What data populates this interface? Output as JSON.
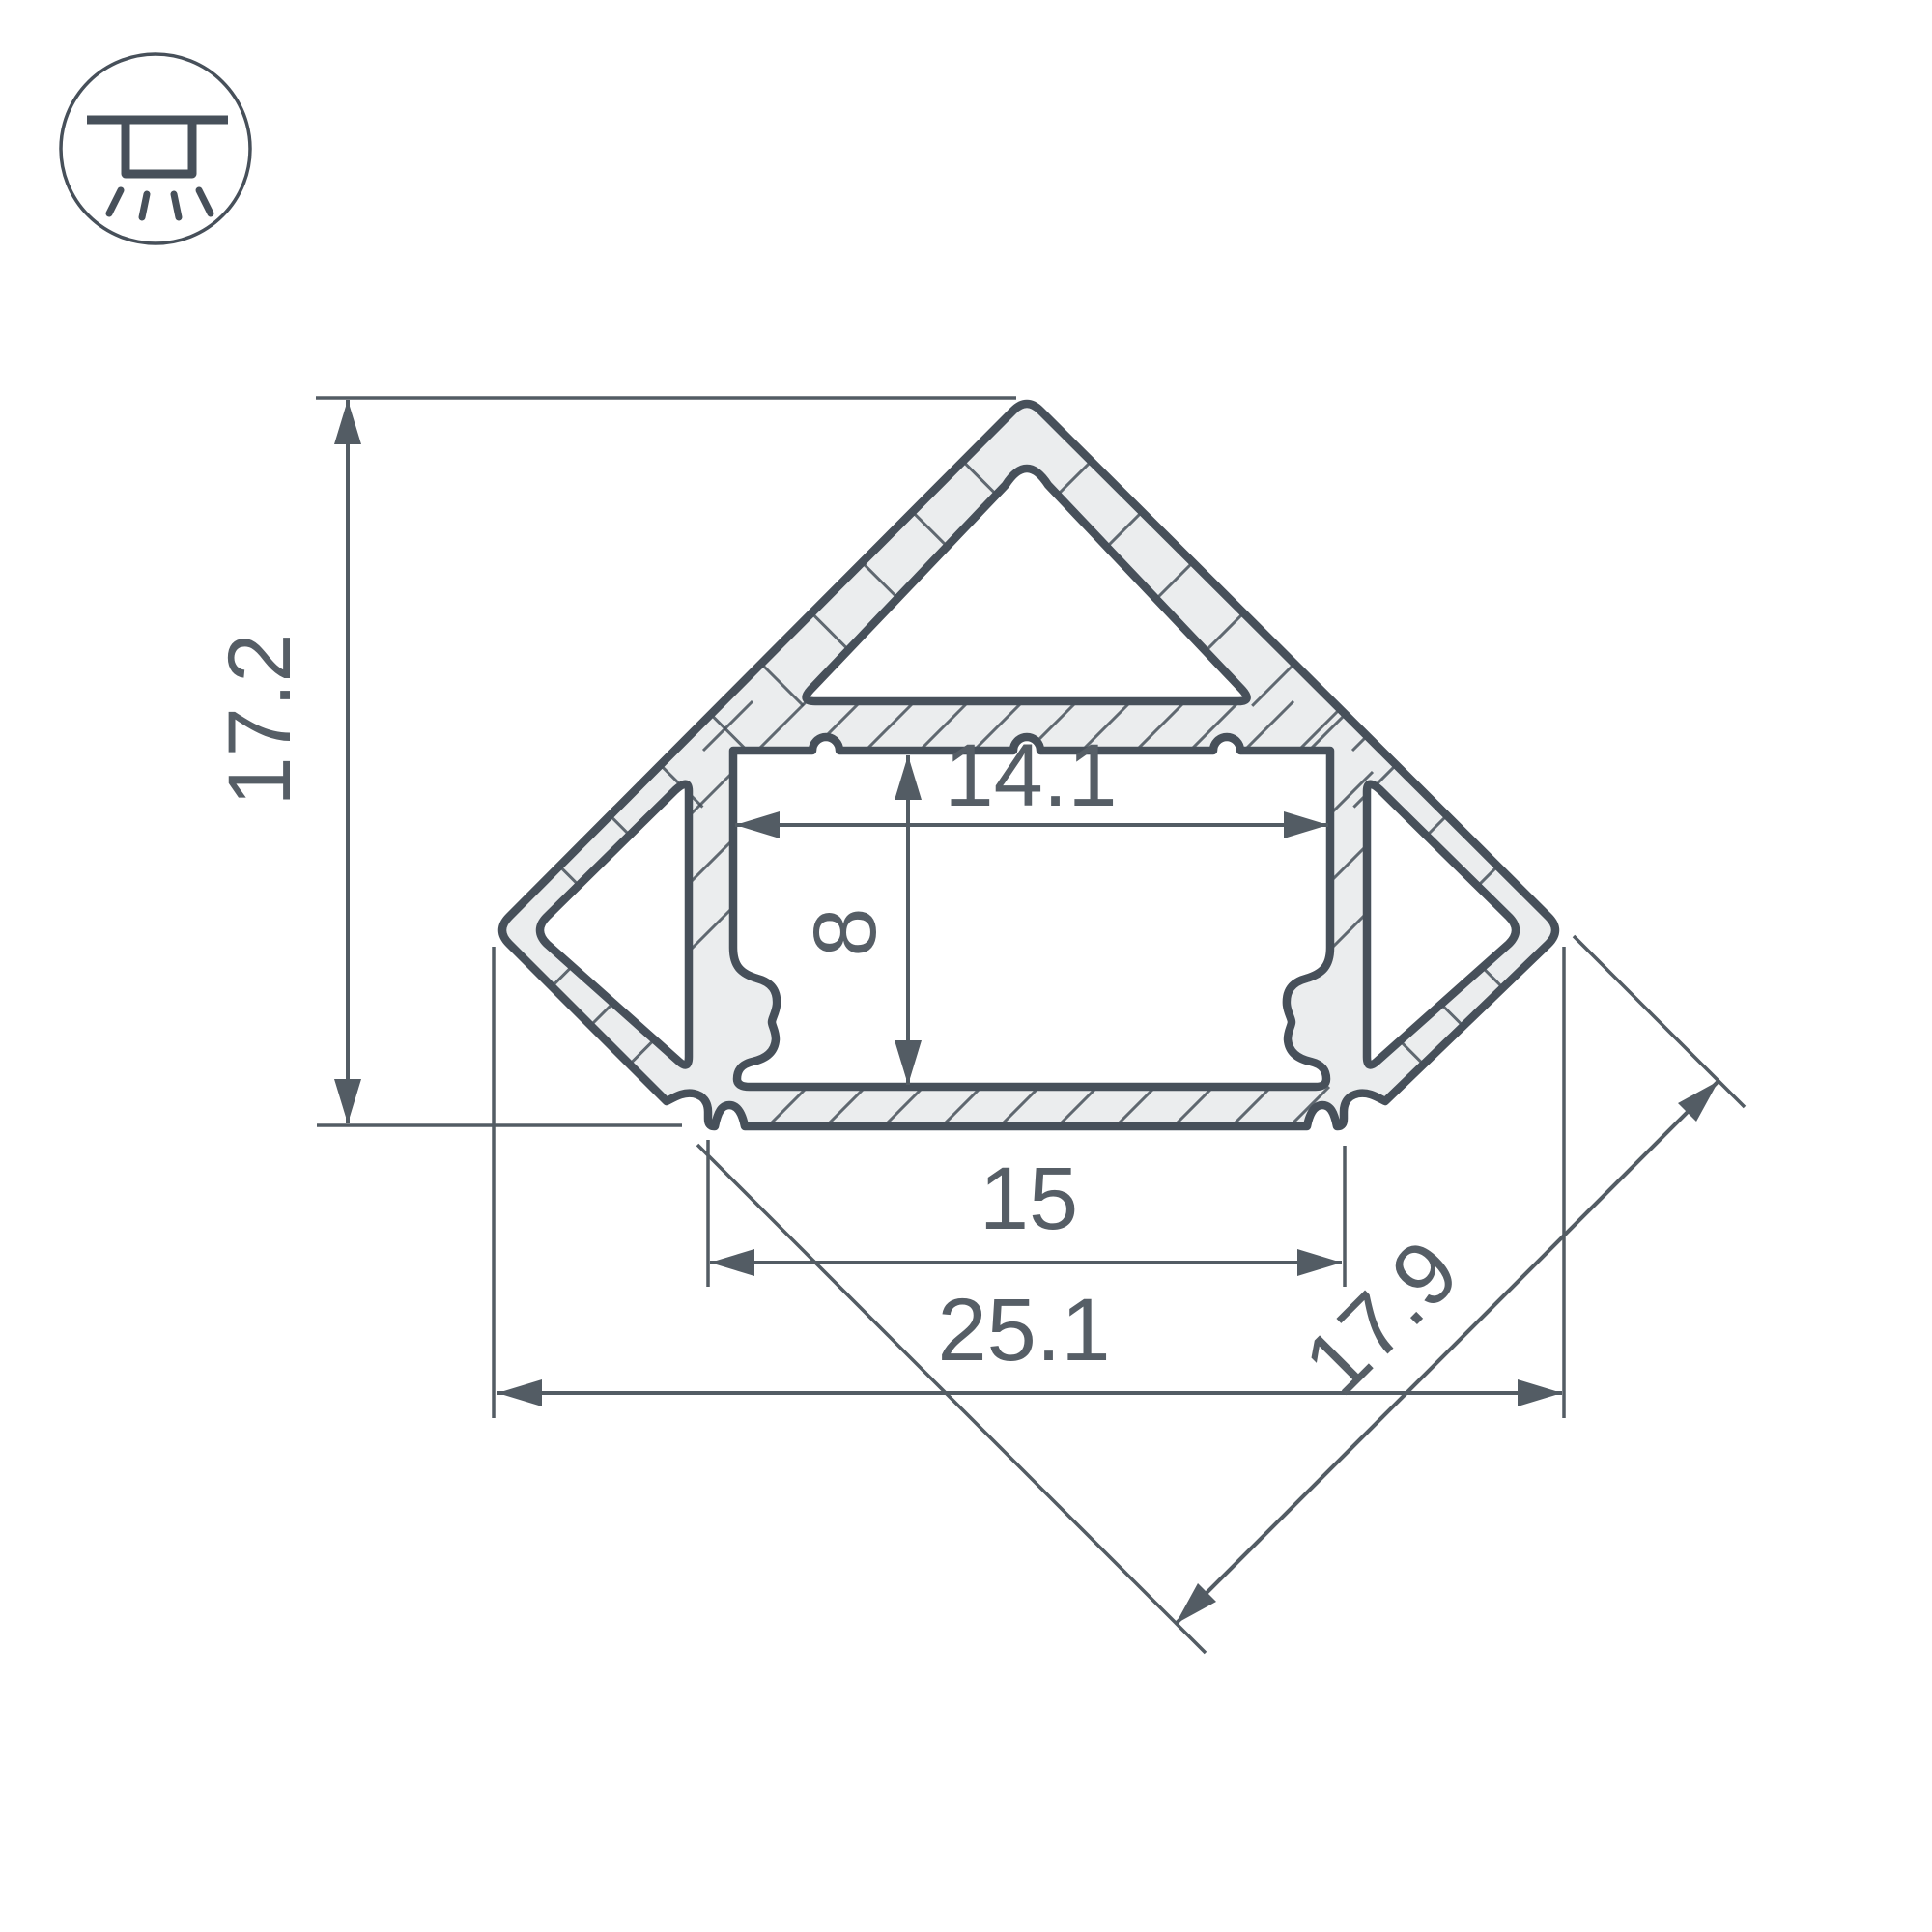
{
  "title": "LED corner profile cross-section drawing",
  "icon": {
    "name": "recessed-ceiling-light-icon"
  },
  "units": "mm",
  "labels": {
    "overall_height": "17.2",
    "inner_width": "14.1",
    "inner_depth": "8",
    "base_width": "15",
    "overall_width": "25.1",
    "face_width": "17.9"
  },
  "colors": {
    "line": "#47505a",
    "dim": "#535c64",
    "text": "#565e66",
    "wall_fill": "#ebedee",
    "background": "#ffffff"
  }
}
